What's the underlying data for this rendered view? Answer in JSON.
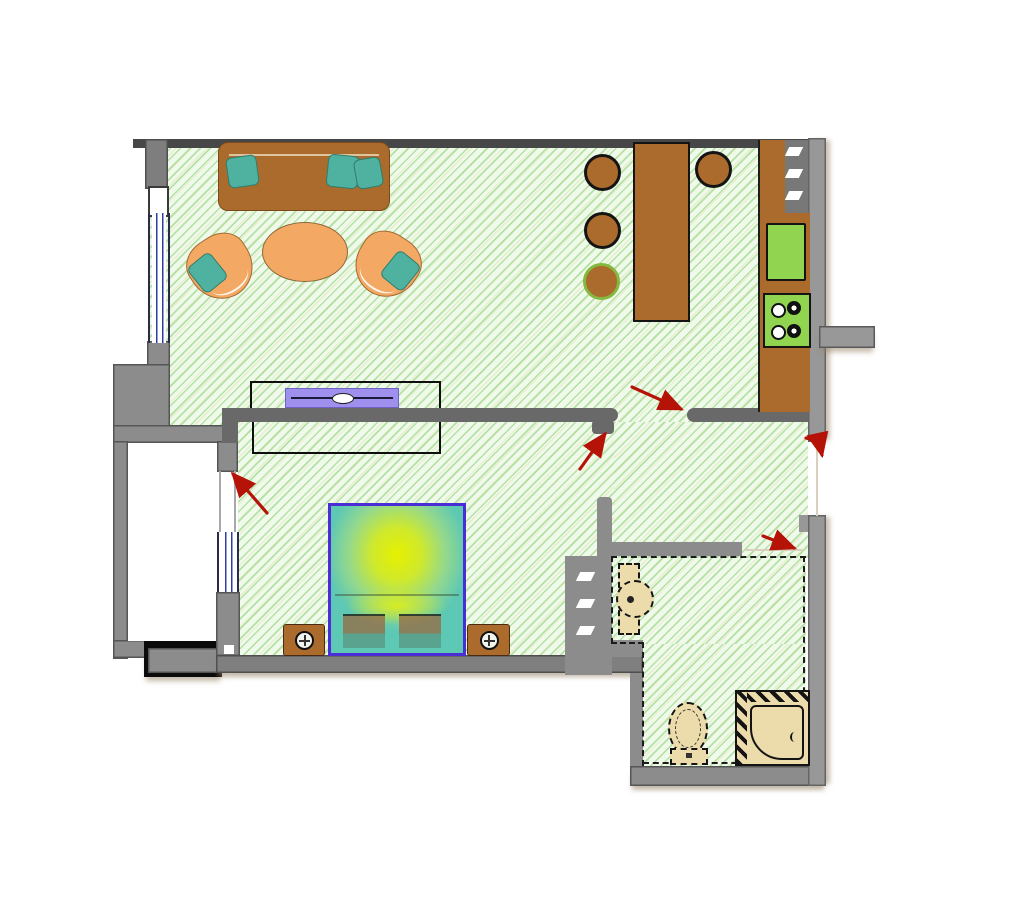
{
  "palette": {
    "wall_gray": "#8c8c8c",
    "wall_dark": "#696969",
    "top_wall": "#474747",
    "hatch_bg": "#f0faeb",
    "wood_brown": "#ab6b2d",
    "chair_orange": "#f3a963",
    "pillow_teal": "#4fb2a0",
    "appliance_green": "#90d450",
    "tv_purple": "#a090ee",
    "bed_frame_purple": "#4b2dd6",
    "bed_center_yellow": "#e6f000",
    "bed_edge_teal": "#5dc8b4",
    "fixture_beige": "#ecdcab",
    "door_arrow_red": "#b51208",
    "window_blue": "#2c3fa3",
    "outline_black": "#141414"
  },
  "floor_plan": {
    "rooms": [
      {
        "id": "living-room",
        "floor": "green-diagonal-hatch",
        "furniture": [
          "sofa-with-three-pillows",
          "oval-coffee-table",
          "armchair-left",
          "armchair-right",
          "tv-stand",
          "wardrobe-outline"
        ]
      },
      {
        "id": "kitchen-area",
        "floor": "green-diagonal-hatch",
        "furniture": [
          "bar-table",
          "bar-stool",
          "bar-stool",
          "bar-stool",
          "bar-stool-green-ring",
          "kitchen-counter",
          "kitchen-sink",
          "stove-four-burners",
          "vent-shaft"
        ]
      },
      {
        "id": "bedroom",
        "floor": "green-diagonal-hatch",
        "furniture": [
          "double-bed-gradient",
          "nightstand-left",
          "nightstand-right"
        ]
      },
      {
        "id": "hallway",
        "floor": "green-diagonal-hatch",
        "furniture": []
      },
      {
        "id": "bathroom",
        "floor": "green-diagonal-hatch-dashed-boundary",
        "furniture": [
          "washbasin",
          "toilet",
          "shower-cabin"
        ]
      },
      {
        "id": "balcony",
        "floor": "white",
        "furniture": [
          "balcony-step-block"
        ]
      }
    ],
    "windows": [
      "living-room-window-left-wall",
      "bedroom-window-left-wall"
    ],
    "openings": [
      "balcony-door",
      "bedroom-door",
      "living-room-to-hallway-opening",
      "entry-door-right-wall",
      "bathroom-door"
    ],
    "door_swing_arrows": 5
  }
}
